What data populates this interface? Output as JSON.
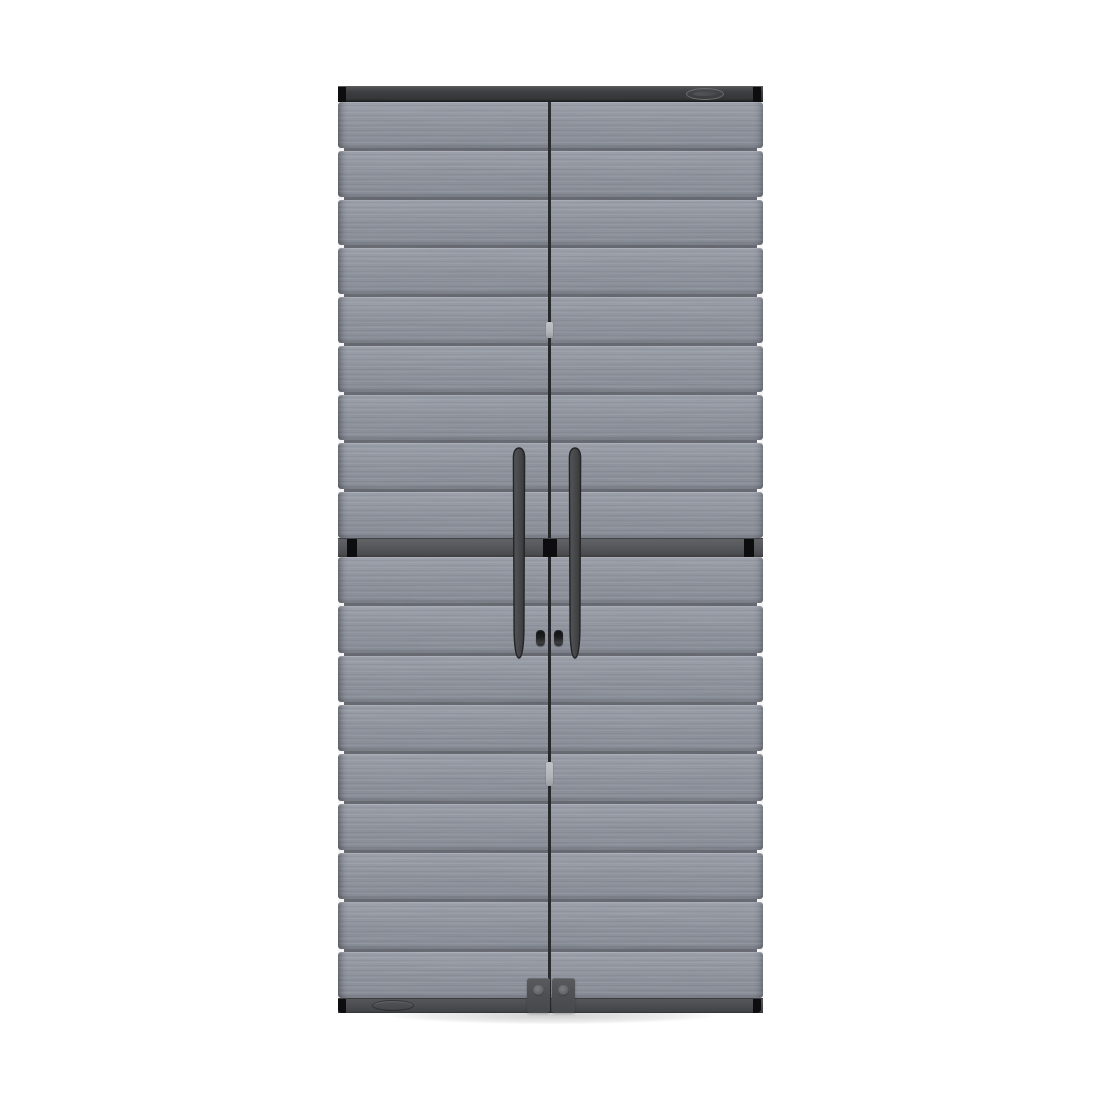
{
  "page": {
    "width": 1100,
    "height": 1100,
    "background": "#ffffff"
  },
  "scene": {
    "type": "product-photo",
    "description": "Tall grey resin two-door storage cabinet with horizontal textured slats, dark charcoal top and bottom trim rails, a central horizontal divider band, two long vertical dark handles with twin latch knobs, a riveted bottom latch plate, and an oval brand badge on the top rail, photographed on a plain white background",
    "object_label": "two-door-storage-cabinet"
  },
  "cabinet": {
    "doors": [
      {
        "label": "left-door"
      },
      {
        "label": "right-door"
      }
    ],
    "slats": {
      "upper_count": 9,
      "lower_count": 9
    },
    "brand_badge": {
      "shape": "oval",
      "text": "",
      "legible": false,
      "position": "top-rail-right"
    },
    "handles": {
      "count": 2,
      "style": "vertical-blade",
      "color_name": "charcoal"
    },
    "latch_knobs": {
      "count": 2
    },
    "bottom_plate": {
      "rivets": 2,
      "position": "bottom-center"
    },
    "emboss_oval": {
      "position": "bottom-left-rail"
    },
    "gap_clips": {
      "count": 2
    }
  },
  "colors": {
    "page_bg": "#ffffff",
    "slat_base": "#8e939d",
    "seam": "#63666e",
    "rail_top": "#3f4043",
    "cap_black": "#0d0d0f",
    "band": "#58595c",
    "handle_fill": "#48494c",
    "handle_edge": "#232425",
    "knob": "#1b1c1e",
    "bottom_rail": "#4d4e51",
    "bracket": "#525356",
    "rivet": "#737477",
    "gap": "#27292c",
    "gap_notch": "#b2b5ba",
    "badge_stroke": "#6c6d6f"
  }
}
